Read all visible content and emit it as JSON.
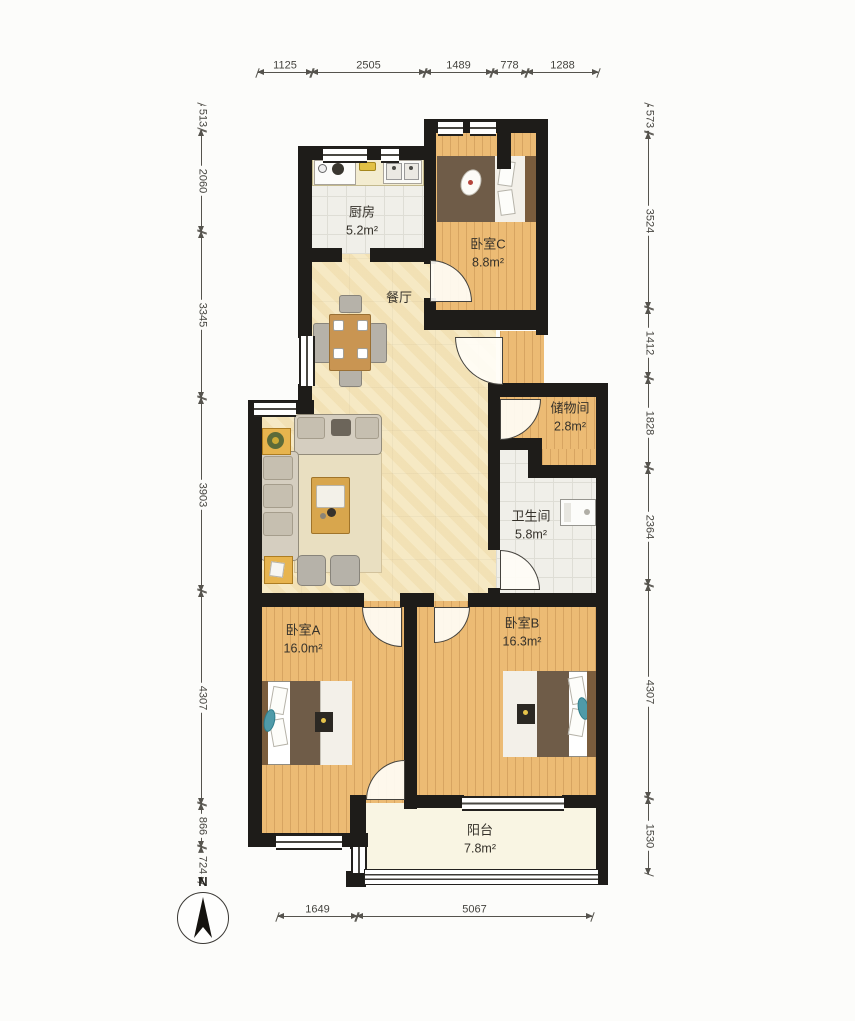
{
  "compass": {
    "label": "N"
  },
  "rooms": {
    "kitchen": {
      "name": "厨房",
      "area": "5.2m²"
    },
    "bedroom_c": {
      "name": "卧室C",
      "area": "8.8m²"
    },
    "dining": {
      "name": "餐厅"
    },
    "storage": {
      "name": "储物间",
      "area": "2.8m²"
    },
    "bathroom": {
      "name": "卫生间",
      "area": "5.8m²"
    },
    "bedroom_a": {
      "name": "卧室A",
      "area": "16.0m²"
    },
    "bedroom_b": {
      "name": "卧室B",
      "area": "16.3m²"
    },
    "balcony": {
      "name": "阳台",
      "area": "7.8m²"
    }
  },
  "dimensions_mm": {
    "top": [
      "1125",
      "2505",
      "1489",
      "778",
      "1288"
    ],
    "left": [
      "513",
      "2060",
      "3345",
      "3903",
      "4307",
      "866",
      "724"
    ],
    "right": [
      "573",
      "3524",
      "1412",
      "1828",
      "2364",
      "4307",
      "1530"
    ],
    "bottom": [
      "1649",
      "5067"
    ]
  },
  "colors": {
    "wall": "#1e1c19",
    "wood_floor": "#ecbb74",
    "living_floor": "#f6e9c4",
    "tile_floor": "#f0efe9",
    "balcony_floor": "#f9f5e3",
    "furniture_wood": "#c99552"
  }
}
